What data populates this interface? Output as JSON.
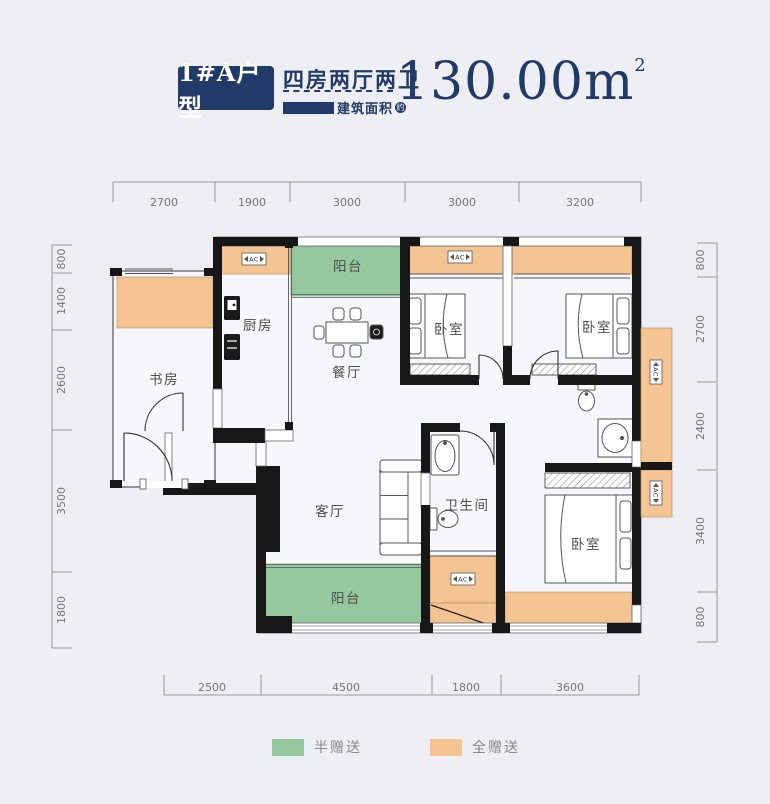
{
  "header": {
    "unit_badge": "1#A户型",
    "layout": "四房两厅两卫",
    "area_label": "建筑面积",
    "approx": "约",
    "area_value": "130.00m",
    "area_sup": "2"
  },
  "plan": {
    "ac": "AC",
    "rooms": {
      "balcony_top": "阳台",
      "kitchen": "厨房",
      "study": "书房",
      "dining": "餐厅",
      "bedroom1": "卧室",
      "bedroom2": "卧室",
      "living": "客厅",
      "bathroom": "卫生间",
      "balcony_bottom": "阳台",
      "master_bedroom": "卧室"
    }
  },
  "dims": {
    "top": [
      "2700",
      "1900",
      "3000",
      "3000",
      "3200"
    ],
    "left": [
      "800",
      "1400",
      "2600",
      "3500",
      "1800"
    ],
    "right": [
      "800",
      "2700",
      "2400",
      "3400",
      "800"
    ],
    "bottom": [
      "2500",
      "4500",
      "1800",
      "3600"
    ]
  },
  "legend": {
    "half_gift": "半赠送",
    "full_gift": "全赠送",
    "half_color": "#96c8a0",
    "full_color": "#f4c492"
  }
}
